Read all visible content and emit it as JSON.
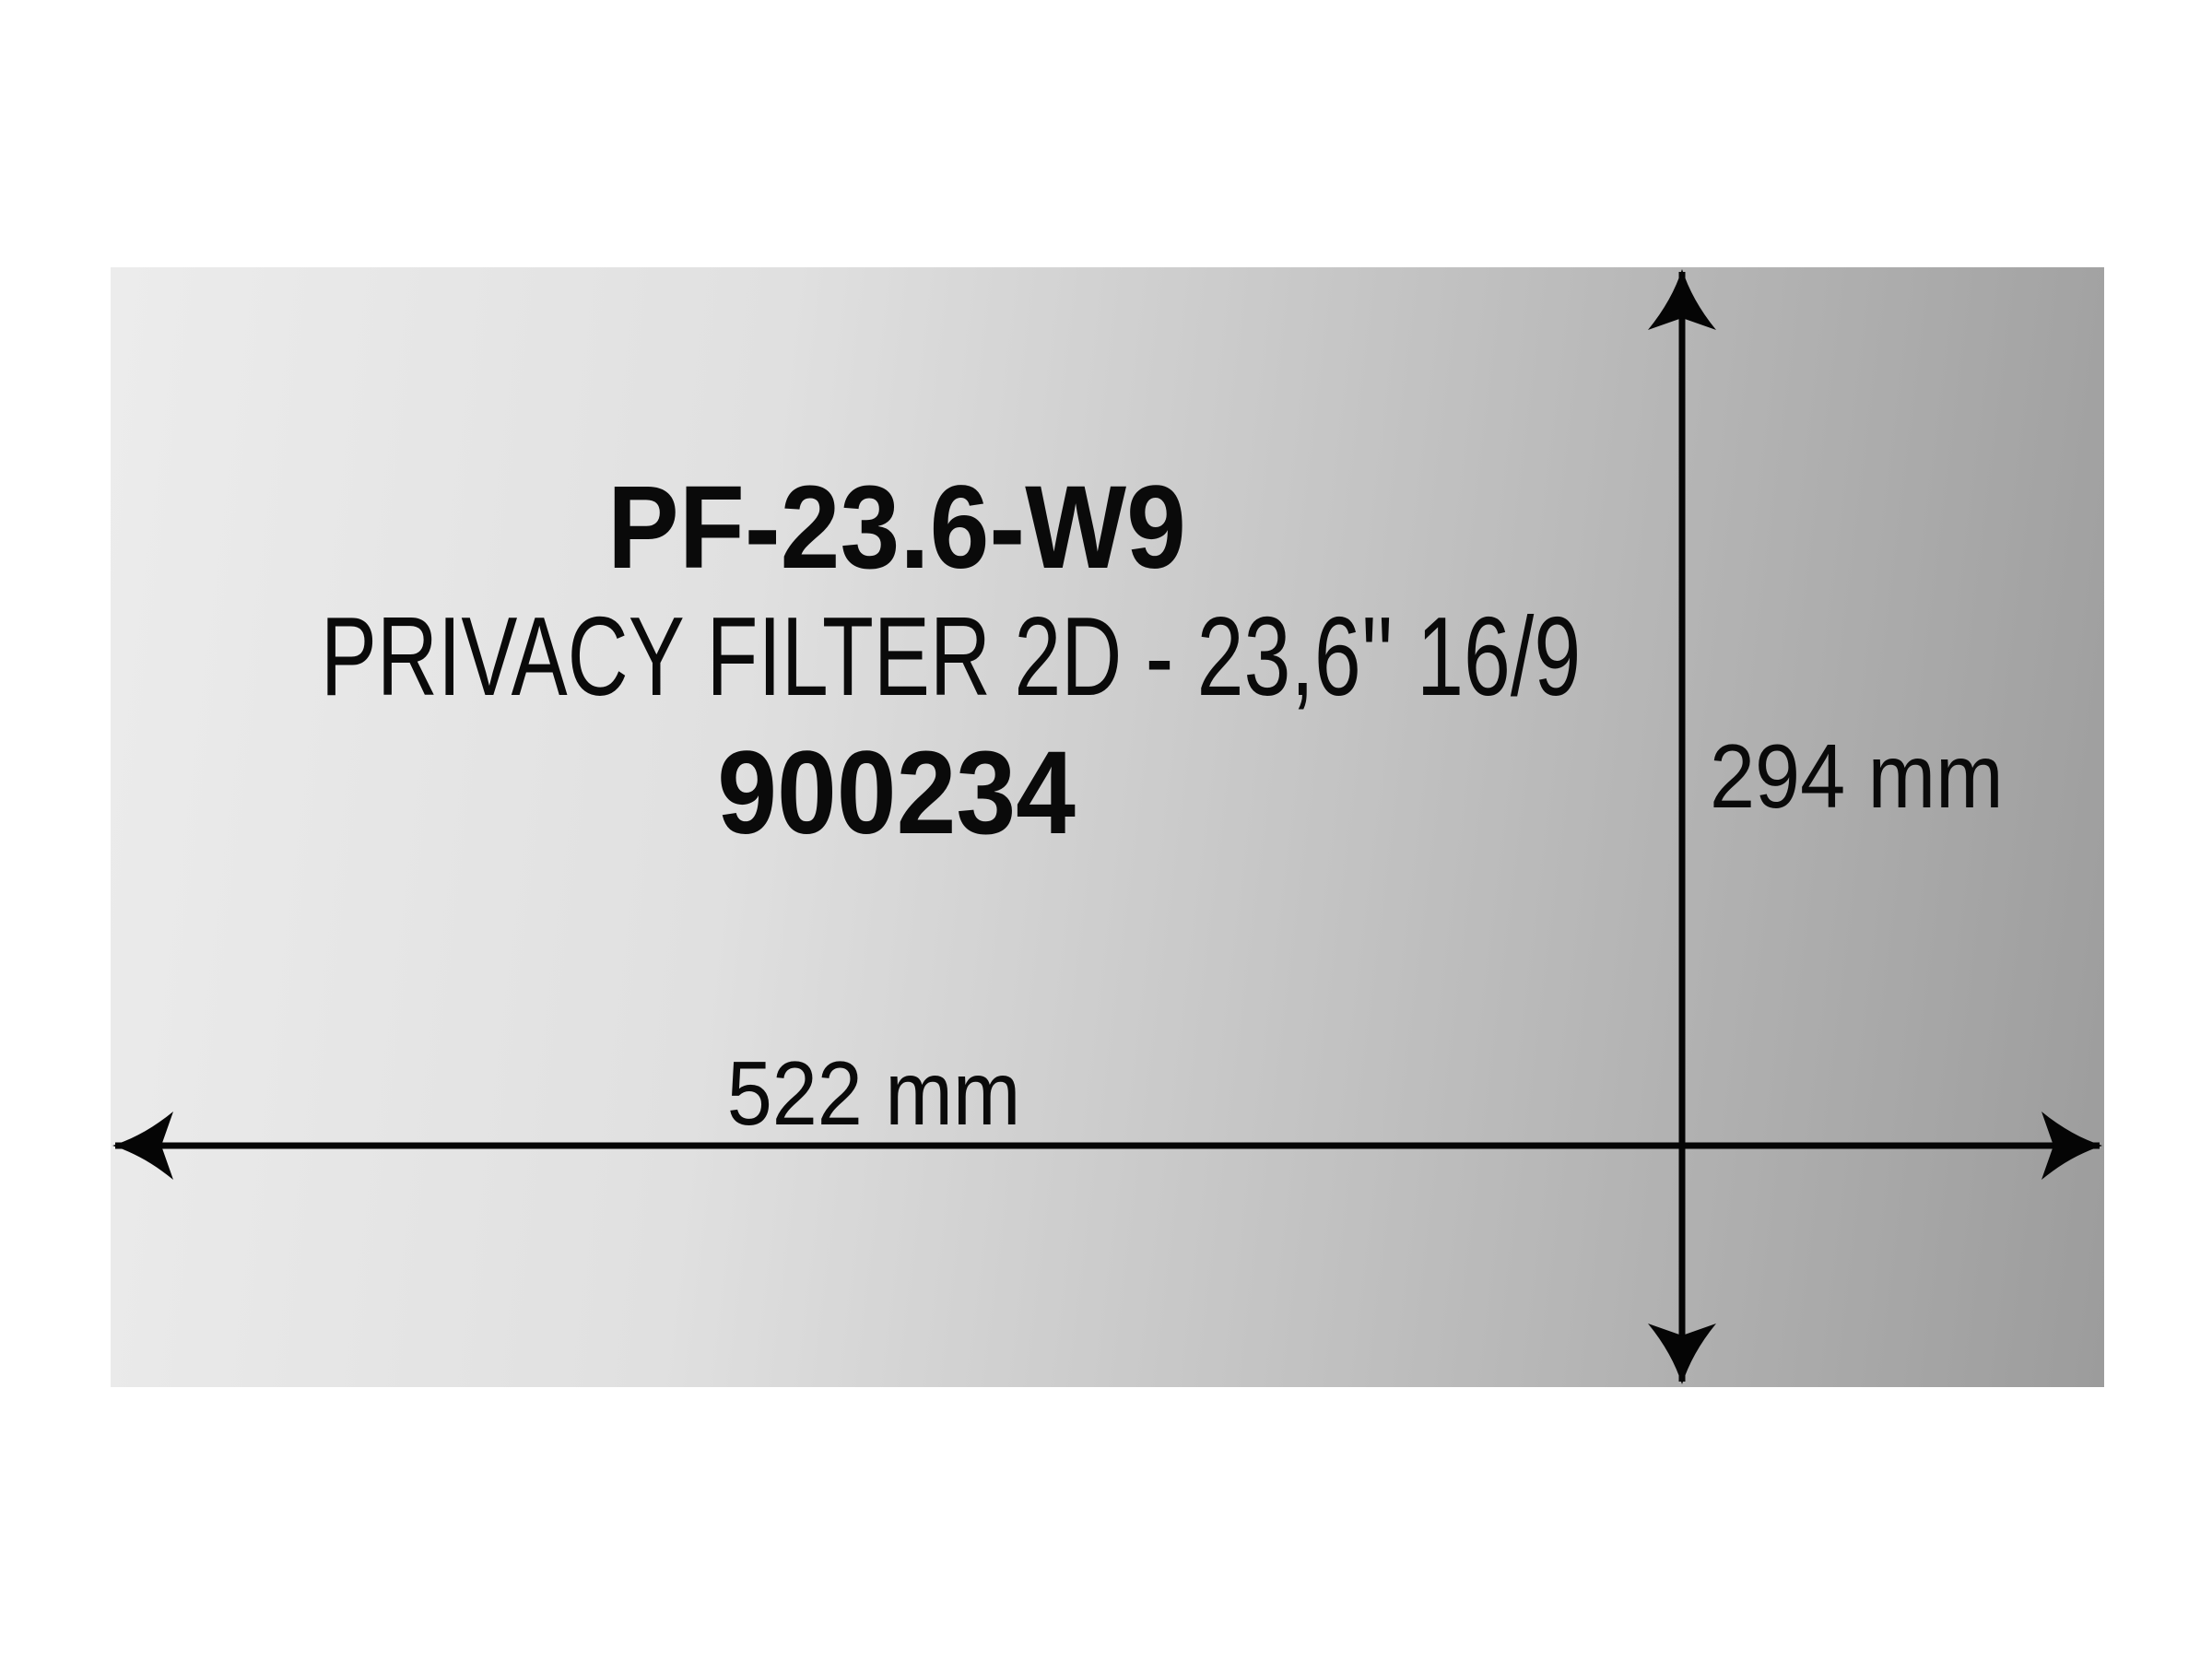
{
  "page": {
    "background_color": "#ffffff",
    "ink_color": "#050505"
  },
  "panel": {
    "description": "privacy filter sheet with diagonal gray gradient",
    "gradient_left_color": "#ececec",
    "gradient_right_color": "#9c9c9c"
  },
  "product": {
    "model": "PF-23.6-W9",
    "description": "PRIVACY FILTER 2D - 23,6'' 16/9",
    "article_number": "900234"
  },
  "dimensions": {
    "width": "522 mm",
    "height": "294 mm"
  },
  "icons": {
    "horizontal_dimension_arrow": "double-headed barbed arrow, horizontal, spans panel width",
    "vertical_dimension_arrow": "double-headed barbed arrow, vertical, spans panel height"
  }
}
